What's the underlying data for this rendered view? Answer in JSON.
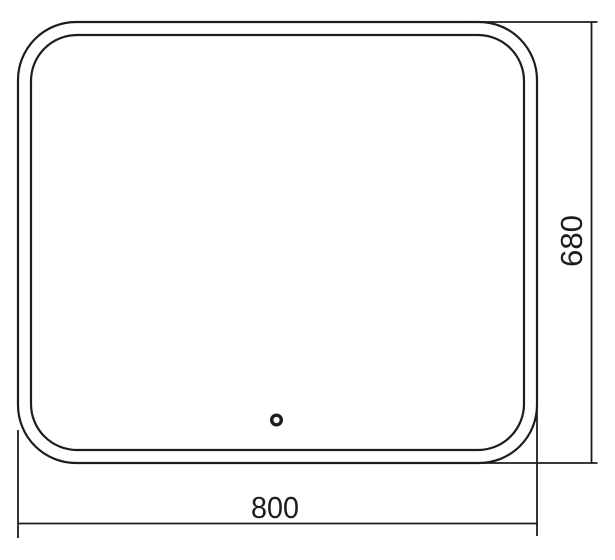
{
  "drawing": {
    "kind": "mirror-front-view-dimension-drawing",
    "stroke_color": "#1d1d1b",
    "background_color": "#ffffff",
    "dimensions": {
      "width": "800",
      "height": "680"
    }
  }
}
